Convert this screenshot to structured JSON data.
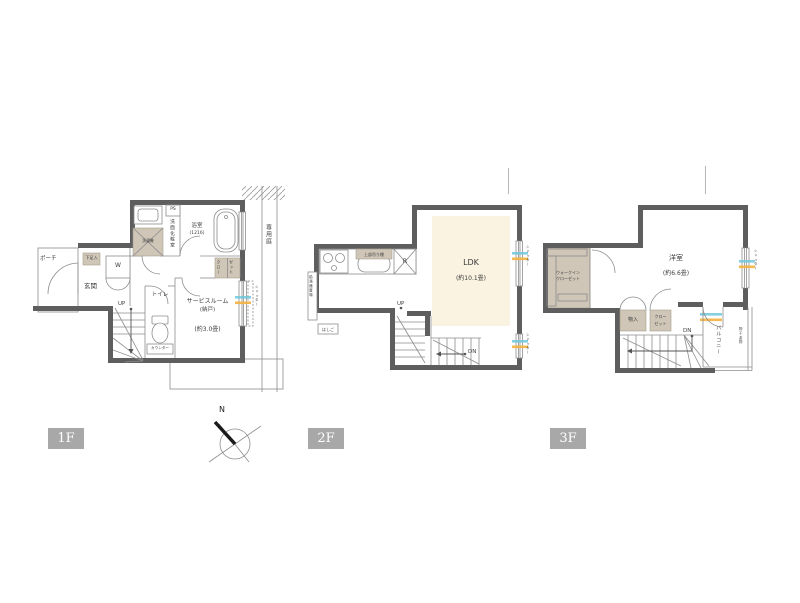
{
  "floors": {
    "f1": {
      "tag": "1F",
      "labels": {
        "porch": "ポーチ",
        "entrance": "玄関",
        "shoe_cabinet": "下足入",
        "w_storage": "W",
        "ps": "PS",
        "washroom": "洗面化粧室",
        "washer": "洗濯機",
        "bathroom": "浴室",
        "bathroom_size": "(1216)",
        "closet_line1": "クロー",
        "closet_line2": "ゼット",
        "toilet": "トイレ",
        "counter": "カウンター",
        "up": "UP",
        "service_room": "サービスルーム",
        "service_room_note": "(納戸)",
        "service_room_size": "(約3.0畳)",
        "private_garden": "専用庭",
        "shutter": "シャッター"
      }
    },
    "f2": {
      "tag": "2F",
      "labels": {
        "ldk": "LDK",
        "ldk_size": "(約10.1畳)",
        "upper_shelf": "上部吊り棚",
        "refrigerator": "R",
        "water_heater": "給湯器置場",
        "ladder": "はしご",
        "up": "UP",
        "dn": "DN",
        "shutter_upper": "シャッター",
        "shutter_lower": "シャッター"
      }
    },
    "f3": {
      "tag": "3F",
      "labels": {
        "bedroom": "洋室",
        "bedroom_size": "(約6.6畳)",
        "wic_line1": "ウォークイン",
        "wic_line2": "クローゼット",
        "storage": "物入",
        "closet_line1": "クロー",
        "closet_line2": "ゼット",
        "dn": "DN",
        "balcony": "バルコニー",
        "laundry_hook": "物干金物",
        "shutter": "シャッター"
      }
    }
  },
  "compass": {
    "north_label": "N"
  },
  "colors": {
    "wall": "#5e5e5e",
    "beige_fill": "#cfc6b7",
    "ldk_fill": "#faf3e2",
    "floor_tag_bg": "#a8a8a8",
    "highlight_cyan": "#6fc8dc",
    "highlight_orange": "#f3b23e"
  }
}
